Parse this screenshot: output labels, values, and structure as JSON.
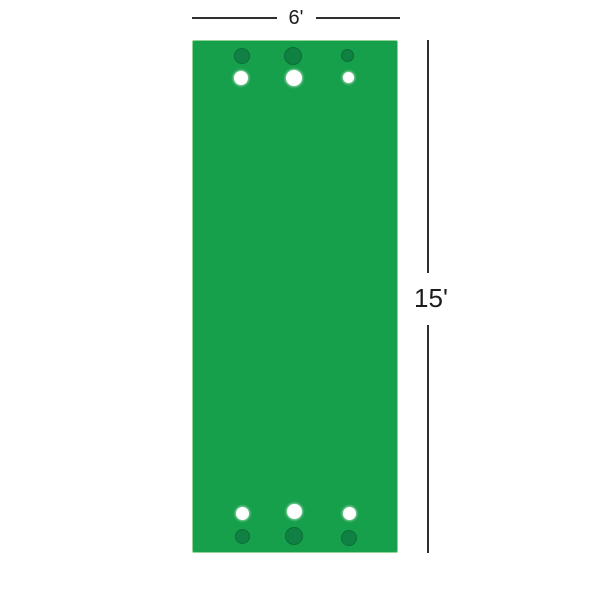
{
  "diagram": {
    "description": "Dimension diagram of a green mat with holes and balls at each end",
    "width_label": "6'",
    "height_label": "15'",
    "colors": {
      "mat_green": "#17a04b",
      "mat_border": "#90d492",
      "hole_fill": "#108142",
      "hole_ring": "#0b6e37",
      "ball_fill": "#ffffff",
      "dimension_line": "#2e2e2e",
      "label_text": "#1c1c1c"
    },
    "geometry": {
      "mat": {
        "left": 192,
        "top": 40,
        "width": 206,
        "height": 513
      },
      "dimension_width": {
        "y": 17,
        "thickness": 2,
        "segments": [
          [
            192,
            277
          ],
          [
            316,
            400
          ]
        ],
        "label_x": 296,
        "label_y": 17
      },
      "dimension_height": {
        "x": 427,
        "thickness": 2,
        "segments": [
          [
            40,
            273
          ],
          [
            325,
            553
          ]
        ],
        "label_x": 431,
        "label_y": 298
      },
      "holes": [
        {
          "x": 242,
          "y": 56,
          "d": 16
        },
        {
          "x": 293,
          "y": 56,
          "d": 18
        },
        {
          "x": 347,
          "y": 55,
          "d": 13
        },
        {
          "x": 242,
          "y": 536,
          "d": 15
        },
        {
          "x": 294,
          "y": 536,
          "d": 18
        },
        {
          "x": 349,
          "y": 538,
          "d": 16
        }
      ],
      "balls": [
        {
          "x": 241,
          "y": 78,
          "d": 14
        },
        {
          "x": 294,
          "y": 78,
          "d": 16
        },
        {
          "x": 348,
          "y": 77,
          "d": 11
        },
        {
          "x": 242,
          "y": 513,
          "d": 13
        },
        {
          "x": 294,
          "y": 511,
          "d": 15
        },
        {
          "x": 349,
          "y": 513,
          "d": 13
        }
      ]
    }
  }
}
